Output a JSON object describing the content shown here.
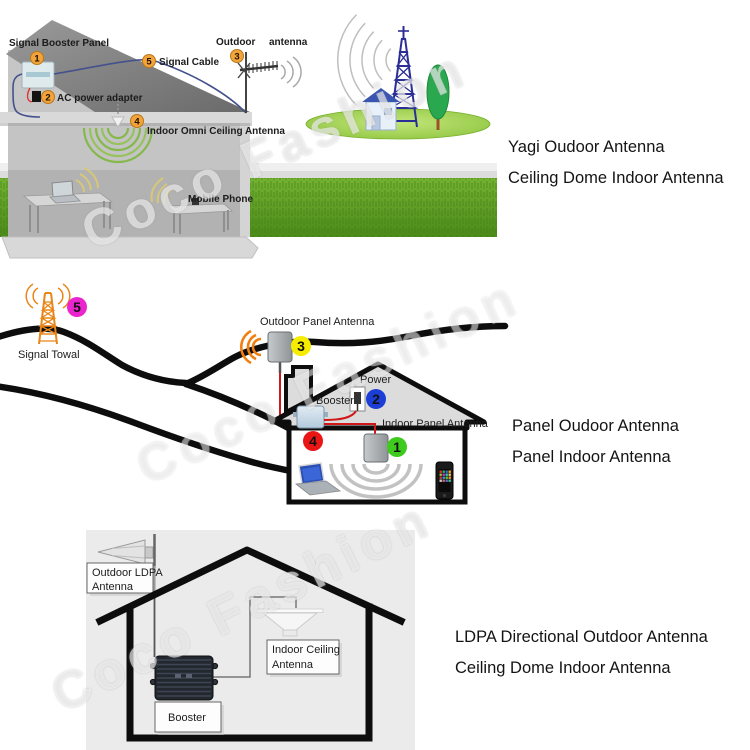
{
  "watermark": {
    "text": "Coco Fashion"
  },
  "top": {
    "signal_booster_panel": "Signal Booster Panel",
    "ac_power_adapter": "AC power adapter",
    "signal_cable": "Signal Cable",
    "outdoor": "Outdoor",
    "antenna": "antenna",
    "indoor_omni": "Indoor Omni Ceiling Antenna",
    "mobile_phone": "Mobile Phone",
    "badge1": "1",
    "badge2": "2",
    "badge3": "3",
    "badge4": "4",
    "badge5": "5",
    "badge_color": "#f2a43a",
    "caption_line1": "Yagi Oudoor Antenna",
    "caption_line2": "Ceiling Dome Indoor Antenna"
  },
  "middle": {
    "signal_towal": "Signal Towal",
    "outdoor_panel_antenna": "Outdoor Panel Antenna",
    "power": "Power",
    "booster": "Booster",
    "indoor_panel_antenna": "Indoor Panel Antenna",
    "badge1": "1",
    "badge2": "2",
    "badge3": "3",
    "badge4": "4",
    "badge5": "5",
    "badge_colors": {
      "one": "#3fcb1e",
      "two": "#1d3ed6",
      "three": "#f6ec00",
      "four": "#ea1515",
      "five": "#ea25cd"
    },
    "caption_line1": "Panel Oudoor Antenna",
    "caption_line2": "Panel Indoor Antenna"
  },
  "bottom": {
    "outdoor_ldpa_line1": "Outdoor LDPA",
    "outdoor_ldpa_line2": "Antenna",
    "indoor_ceiling_line1": "Indoor Ceiling",
    "indoor_ceiling_line2": "Antenna",
    "booster": "Booster",
    "caption_line1": "LDPA Directional Outdoor Antenna",
    "caption_line2": "Ceiling Dome Indoor Antenna"
  }
}
